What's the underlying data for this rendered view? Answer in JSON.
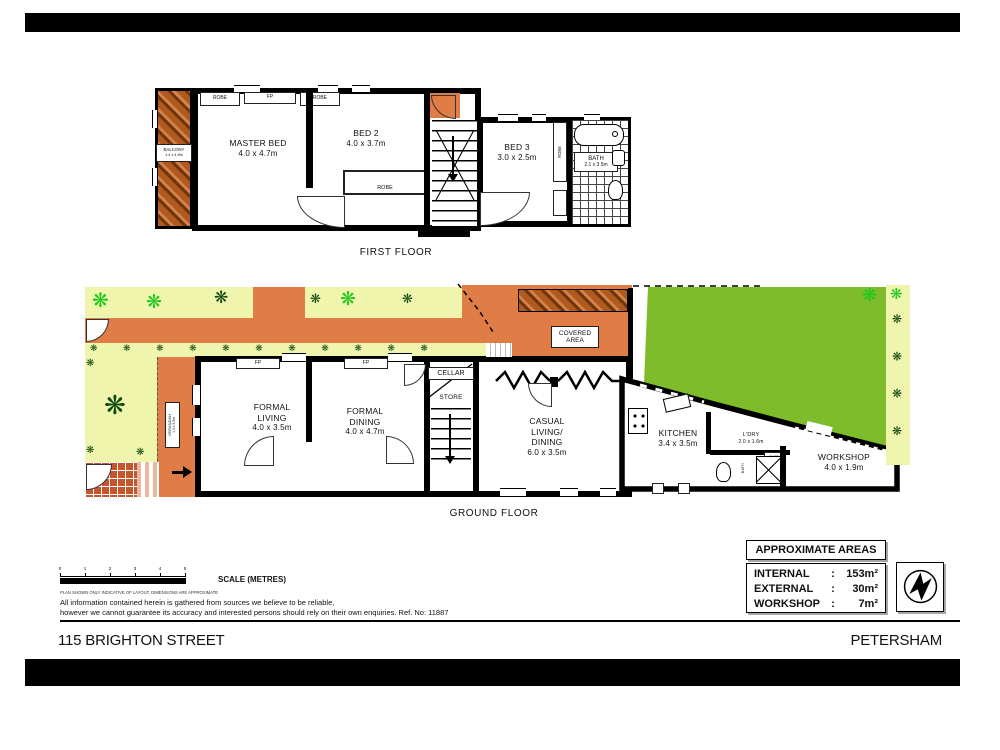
{
  "icons": {
    "plant": "❋",
    "plant_row": "❋ ❋ ❋ ❋ ❋ ❋ ❋ ❋ ❋ ❋ ❋",
    "plant_col": "❋ ❋ ❋ ❋"
  },
  "colors": {
    "terracotta": "#E07C46",
    "lawn": "#7FBC2B",
    "garden": "#EFF5AC",
    "tile": "#C4562E",
    "plant_bright": "#1EC61E",
    "plant_dark": "#114911"
  },
  "first_floor": {
    "caption": "FIRST FLOOR",
    "balcony": {
      "name": "BALCONY",
      "dim": "1.4 x 4.8m"
    },
    "master": {
      "name": "MASTER BED",
      "dim": "4.0 x 4.7m"
    },
    "bed2": {
      "name": "BED 2",
      "dim": "4.0 x 3.7m"
    },
    "bed3": {
      "name": "BED 3",
      "dim": "3.0 x 2.5m"
    },
    "bath": {
      "name": "BATH",
      "dim": "2.1 x 3.5m"
    },
    "robe": "ROBE",
    "fp": "FP"
  },
  "ground_floor": {
    "caption": "GROUND FLOOR",
    "verandah": {
      "name": "VERANDAH",
      "dim": "1.3 x 5.3m"
    },
    "formal_living": {
      "name": "FORMAL LIVING",
      "dim": "4.0 x 3.5m"
    },
    "formal_dining": {
      "name": "FORMAL DINING",
      "dim": "4.0 x 4.7m"
    },
    "cellar": "CELLAR",
    "store": "STORE",
    "fp": "FP",
    "casual": {
      "name": "CASUAL LIVING/ DINING",
      "dim": "6.0 x 3.5m"
    },
    "covered": {
      "line1": "COVERED",
      "line2": "AREA"
    },
    "kitchen": {
      "name": "KITCHEN",
      "dim": "3.4 x 3.5m"
    },
    "laundry": {
      "name": "L'DRY",
      "dim": "2.0 x 1.6m"
    },
    "cupd": "CUPD",
    "bath_small": "BATH",
    "workshop": {
      "name": "WORKSHOP",
      "dim": "4.0 x 1.9m"
    }
  },
  "scale": {
    "ticks": [
      "0",
      "1",
      "2",
      "3",
      "4",
      "5"
    ],
    "label": "SCALE (METRES)"
  },
  "notes": {
    "fineprint": "PLAN SHOWN ONLY INDICATIVE OF LAYOUT. DIMENSIONS ARE APPROXIMATE",
    "line1": "All information contained herein is gathered from sources we believe to be reliable,",
    "line2": "however we cannot guarantee its accuracy and interested persons should rely on their own enquiries. Ref. No: 11887"
  },
  "areas": {
    "title": "APPROXIMATE AREAS",
    "rows": [
      {
        "label": "INTERNAL",
        "sep": ":",
        "value": "153m²"
      },
      {
        "label": "EXTERNAL",
        "sep": ":",
        "value": "30m²"
      },
      {
        "label": "WORKSHOP",
        "sep": ":",
        "value": "7m²"
      }
    ]
  },
  "footer": {
    "address": "115 BRIGHTON STREET",
    "suburb": "PETERSHAM"
  }
}
